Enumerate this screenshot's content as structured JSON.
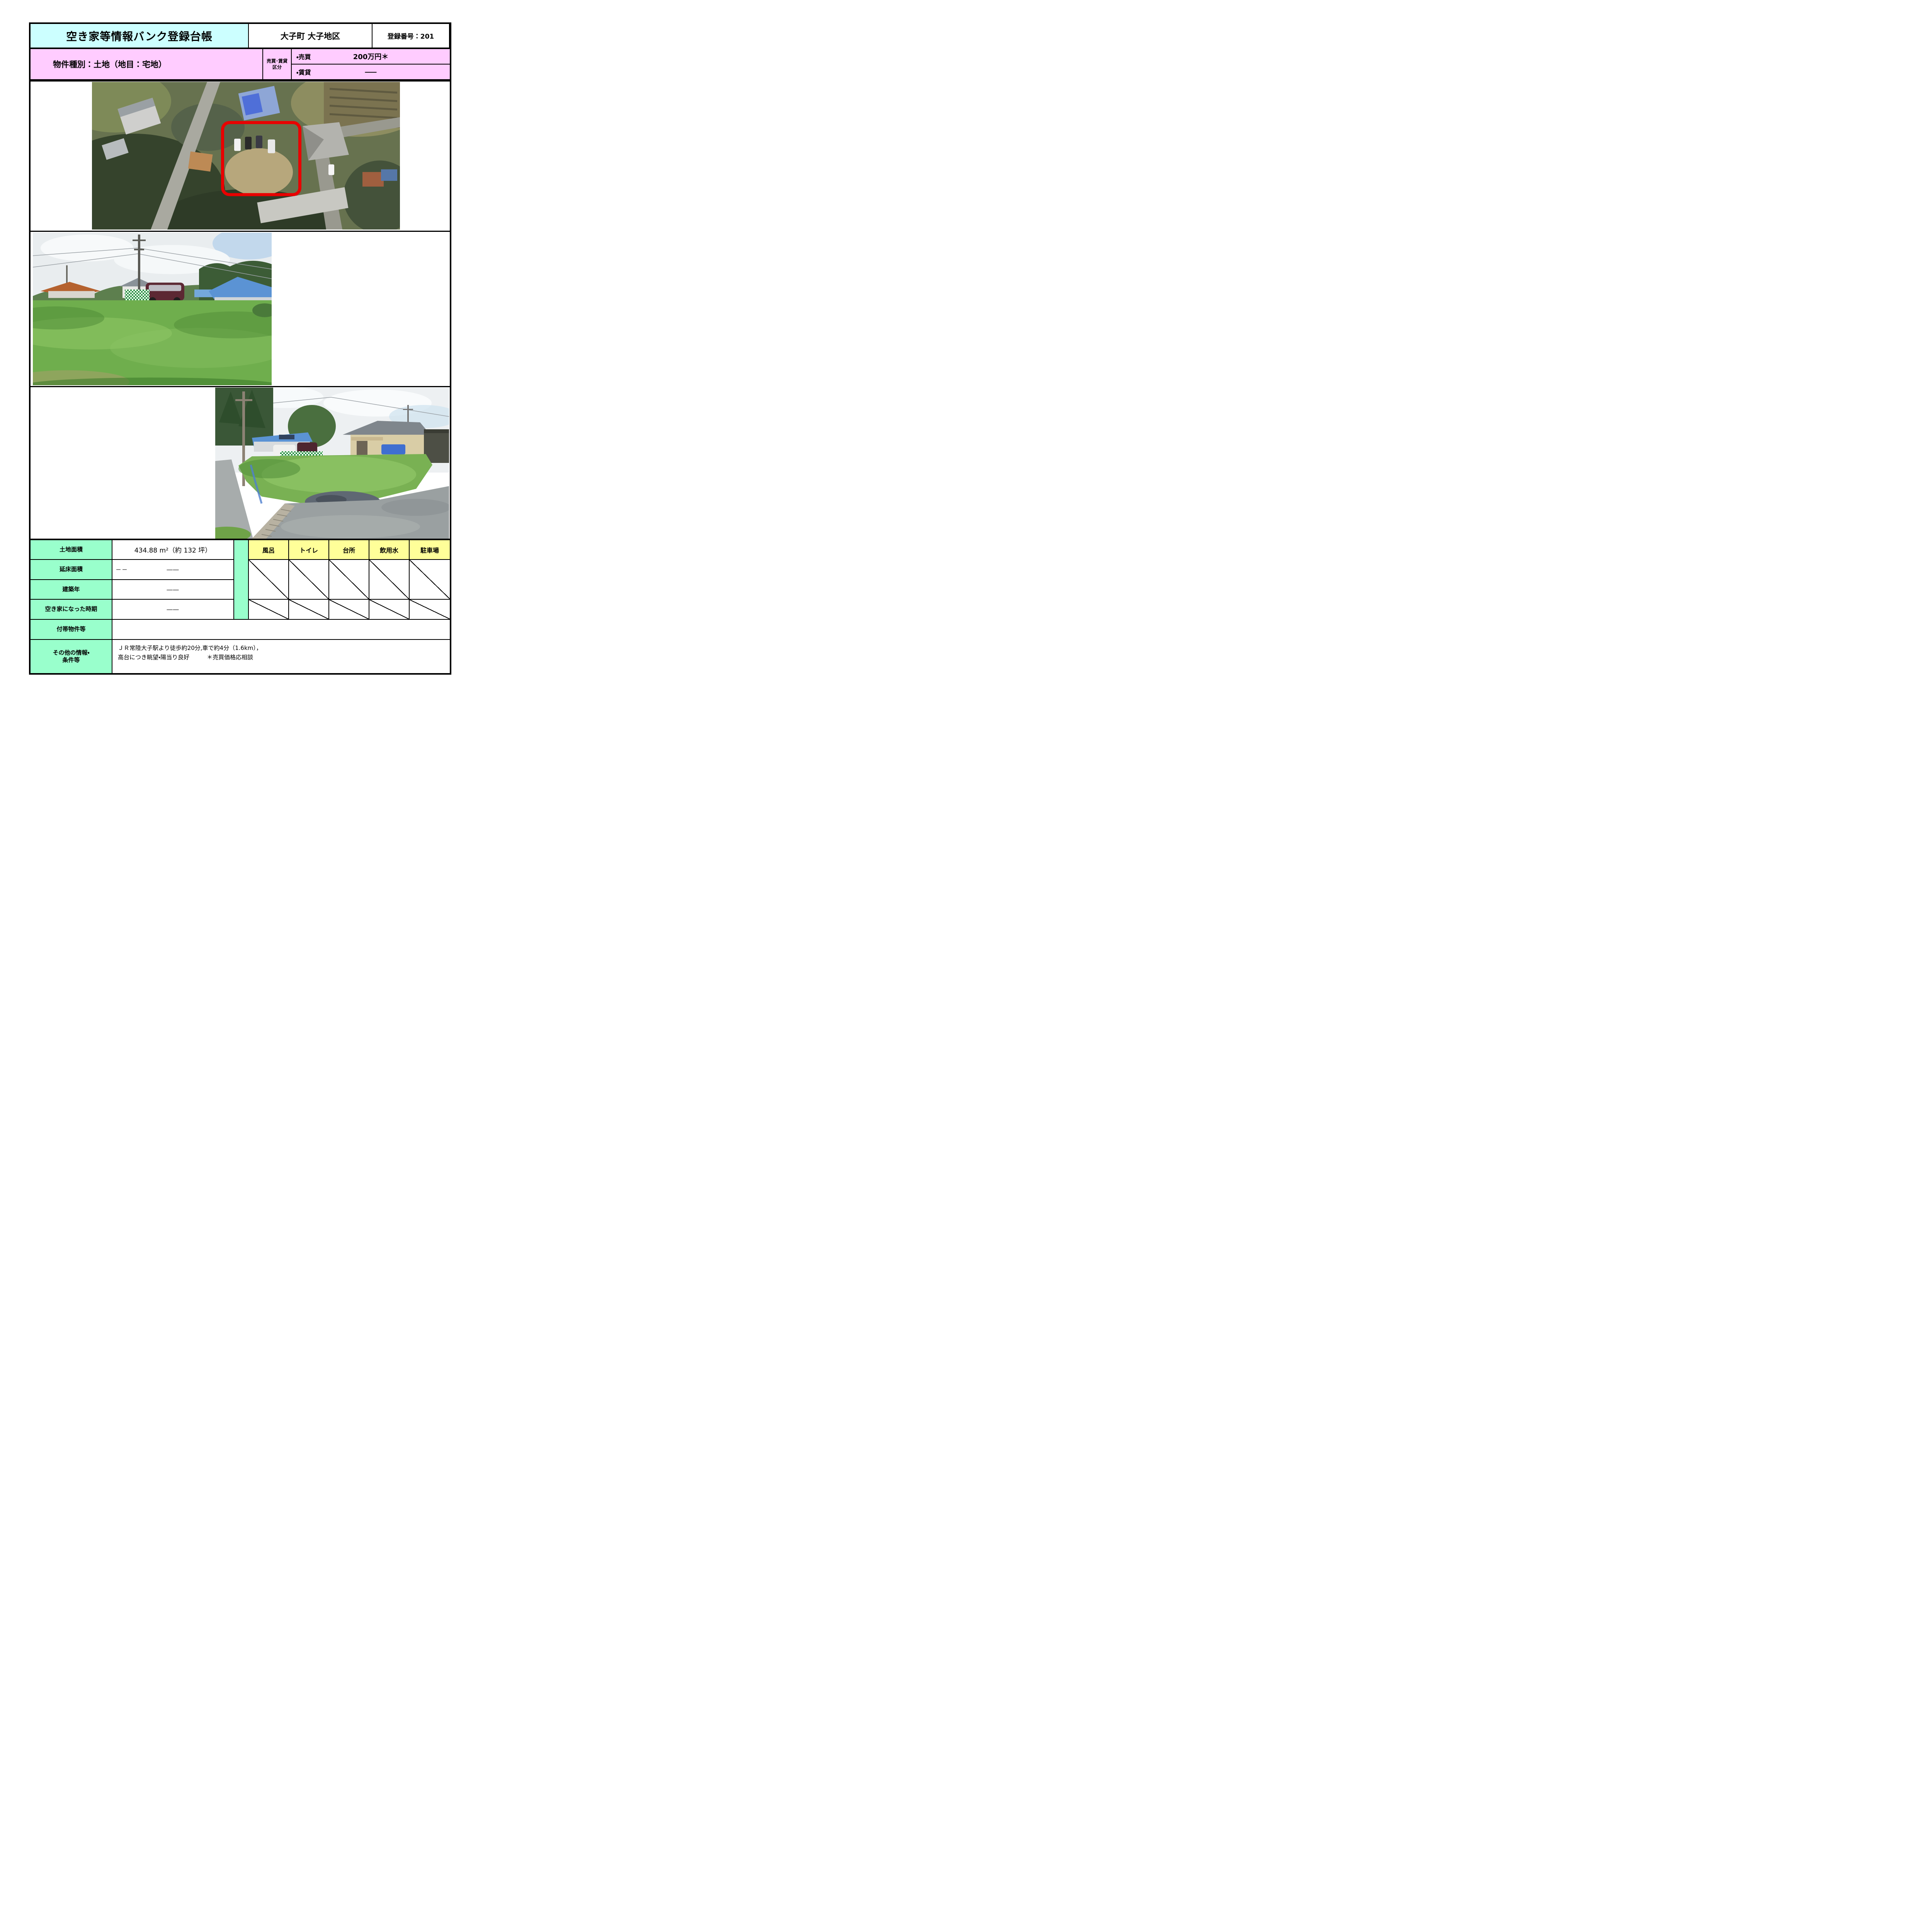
{
  "header": {
    "title": "空き家等情報バンク登録台帳",
    "district": "大子町 大子地区",
    "registration_no": "登録番号：201"
  },
  "property": {
    "type": "物件種別：土地（地目：宅地）",
    "category_line1": "売買･賃貸",
    "category_line2": "区分",
    "sale_label": "・売買",
    "sale_price": "200万円＊",
    "rent_label": "・賃貸",
    "rent_price": "――"
  },
  "details": {
    "rows": [
      {
        "label": "土地面積",
        "value": "434.88 m²（約 132 坪）"
      },
      {
        "label": "延床面積",
        "value_left": "－－",
        "value": "――"
      },
      {
        "label": "建築年",
        "value": "――"
      },
      {
        "label": "空き家になった時期",
        "value": "――"
      },
      {
        "label": "付帯物件等",
        "value": ""
      },
      {
        "label_line1": "その他の情報・",
        "label_line2": "条件等",
        "value_line1": "ＪＲ常陸大子駅より徒歩約20分,車で約4分（1.6km），",
        "value_line2": "高台につき眺望・陽当り良好　　　＊売買価格応相談"
      }
    ]
  },
  "facilities": {
    "headers": [
      "風呂",
      "トイレ",
      "台所",
      "飲用水",
      "駐車場"
    ]
  },
  "colors": {
    "title_bg": "#ccffff",
    "property_bg": "#ffccff",
    "label_bg": "#99ffcc",
    "facility_bg": "#ffff99",
    "parcel_outline": "#e90000",
    "border": "#000000"
  }
}
